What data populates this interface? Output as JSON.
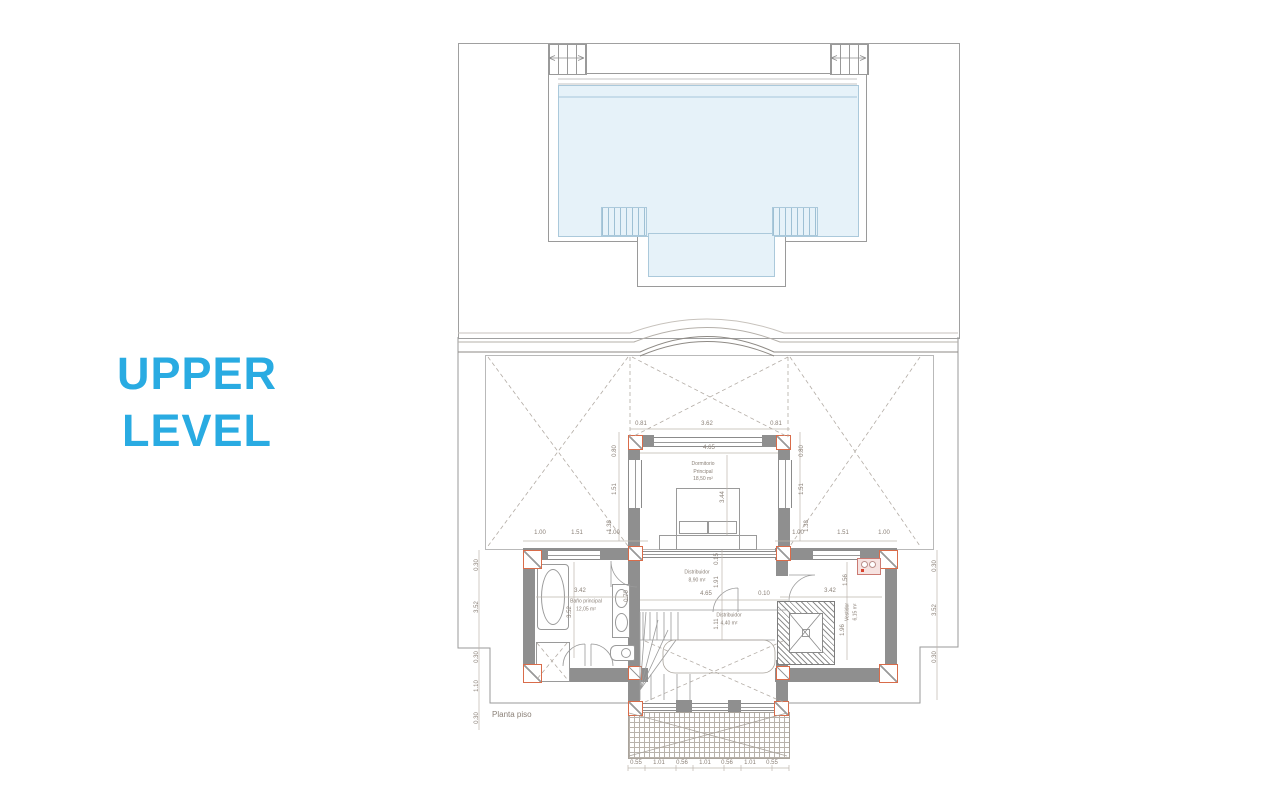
{
  "title": {
    "line1": "UPPER",
    "line2": "LEVEL",
    "color": "#29ABE2"
  },
  "plan": {
    "caption": "Planta piso",
    "room_labels": [
      {
        "lines": [
          "Dormitorio",
          "Principal",
          "18,50 m²"
        ],
        "x": 703,
        "y": 472
      },
      {
        "lines": [
          "Baño principal",
          "12,05 m²"
        ],
        "x": 586,
        "y": 606
      },
      {
        "lines": [
          "Distribuidor",
          "8,90 m²"
        ],
        "x": 697,
        "y": 577
      },
      {
        "lines": [
          "Distribuidor",
          "4,40 m²"
        ],
        "x": 729,
        "y": 620
      },
      {
        "lines": [
          "Vestidor",
          "6,15 m²"
        ],
        "x": 852,
        "y": 612,
        "r": 1
      }
    ],
    "dimensions": [
      {
        "t": "0.81",
        "x": 641,
        "y": 424
      },
      {
        "t": "3.62",
        "x": 707,
        "y": 424
      },
      {
        "t": "0.81",
        "x": 776,
        "y": 424
      },
      {
        "t": "4.65",
        "x": 709,
        "y": 448
      },
      {
        "t": "3.44",
        "x": 723,
        "y": 497,
        "r": 1
      },
      {
        "t": "0.80",
        "x": 615,
        "y": 451,
        "r": 1
      },
      {
        "t": "1.51",
        "x": 615,
        "y": 489,
        "r": 1
      },
      {
        "t": "1.38",
        "x": 610,
        "y": 526,
        "r": 1
      },
      {
        "t": "0.80",
        "x": 802,
        "y": 451,
        "r": 1
      },
      {
        "t": "1.51",
        "x": 802,
        "y": 489,
        "r": 1
      },
      {
        "t": "1.38",
        "x": 807,
        "y": 526,
        "r": 1
      },
      {
        "t": "1.00",
        "x": 540,
        "y": 533
      },
      {
        "t": "1.51",
        "x": 577,
        "y": 533
      },
      {
        "t": "1.00",
        "x": 614,
        "y": 533
      },
      {
        "t": "1.00",
        "x": 798,
        "y": 533
      },
      {
        "t": "1.51",
        "x": 843,
        "y": 533
      },
      {
        "t": "1.00",
        "x": 884,
        "y": 533
      },
      {
        "t": "0.15",
        "x": 717,
        "y": 559,
        "r": 1
      },
      {
        "t": "1.91",
        "x": 717,
        "y": 582,
        "r": 1
      },
      {
        "t": "4.65",
        "x": 706,
        "y": 594
      },
      {
        "t": "0.10",
        "x": 764,
        "y": 594
      },
      {
        "t": "1.11",
        "x": 717,
        "y": 624,
        "r": 1
      },
      {
        "t": "3.42",
        "x": 580,
        "y": 591
      },
      {
        "t": "3.52",
        "x": 570,
        "y": 612,
        "r": 1
      },
      {
        "t": "0.70",
        "x": 627,
        "y": 596,
        "r": 1
      },
      {
        "t": "1.56",
        "x": 846,
        "y": 580,
        "r": 1
      },
      {
        "t": "3.42",
        "x": 830,
        "y": 591
      },
      {
        "t": "1.96",
        "x": 843,
        "y": 630,
        "r": 1
      },
      {
        "t": "0.30",
        "x": 477,
        "y": 565,
        "r": 1
      },
      {
        "t": "3.52",
        "x": 477,
        "y": 607,
        "r": 1
      },
      {
        "t": "0.30",
        "x": 477,
        "y": 657,
        "r": 1
      },
      {
        "t": "1.10",
        "x": 477,
        "y": 686,
        "r": 1
      },
      {
        "t": "0.30",
        "x": 477,
        "y": 718,
        "r": 1
      },
      {
        "t": "0.30",
        "x": 935,
        "y": 566,
        "r": 1
      },
      {
        "t": "3.52",
        "x": 935,
        "y": 610,
        "r": 1
      },
      {
        "t": "0.30",
        "x": 935,
        "y": 657,
        "r": 1
      },
      {
        "t": "0.55",
        "x": 636,
        "y": 763
      },
      {
        "t": "1.01",
        "x": 659,
        "y": 763
      },
      {
        "t": "0.56",
        "x": 682,
        "y": 763
      },
      {
        "t": "1.01",
        "x": 705,
        "y": 763
      },
      {
        "t": "0.56",
        "x": 727,
        "y": 763
      },
      {
        "t": "1.01",
        "x": 750,
        "y": 763
      },
      {
        "t": "0.55",
        "x": 772,
        "y": 763
      }
    ]
  }
}
